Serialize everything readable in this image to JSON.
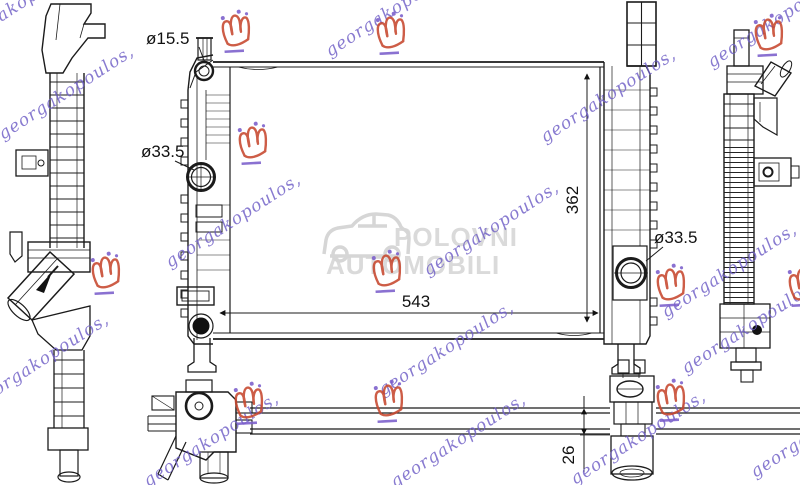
{
  "page": {
    "type": "technical-part-drawing",
    "subject": "radiator-multi-view"
  },
  "dimensions": {
    "cap_diameter": "ø15.5",
    "inlet_diameter": "ø33.5",
    "outlet_diameter": "ø33.5",
    "core_height": "362",
    "core_width": "543",
    "core_thickness": "26"
  },
  "watermark": {
    "script_text": "georgakopoulos,",
    "script_color": "#6e5ec6",
    "crown_color": "#c7472e",
    "crown_accent_color": "#7b5ecb",
    "center_line1": "POLOVNI",
    "center_line2": "AUTOMOBILI",
    "center_color": "#d6d6d6"
  },
  "colors": {
    "background": "#ffffff",
    "line": "#1b1b1b"
  }
}
